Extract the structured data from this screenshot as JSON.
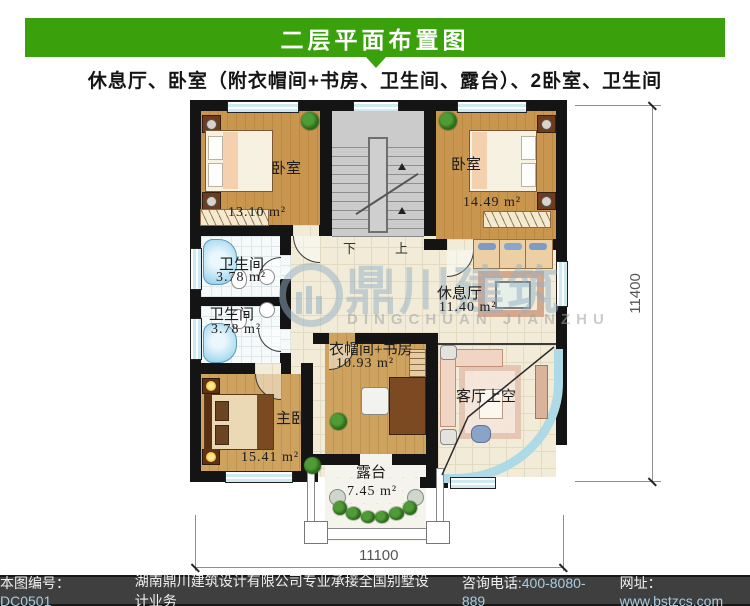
{
  "header": {
    "title": "二层平面布置图",
    "subtitle": "休息厅、卧室（附衣帽间+书房、卫生间、露台）、2卧室、卫生间",
    "accent_color": "#3aa10c"
  },
  "plan": {
    "rooms": {
      "bedroom_tl": {
        "label": "卧室",
        "area": "13.10 m²"
      },
      "bedroom_tr": {
        "label": "卧室",
        "area": "14.49 m²"
      },
      "bath_1": {
        "label": "卫生间",
        "area": "3.78 m²"
      },
      "bath_2": {
        "label": "卫生间",
        "area": "3.78 m²"
      },
      "lounge": {
        "label": "休息厅",
        "area": "11.40 m²"
      },
      "cloak_study": {
        "label": "衣帽间+书房",
        "area": "10.93 m²"
      },
      "master": {
        "label": "主卧",
        "area": "15.41 m²"
      },
      "living_void": {
        "label": "客厅上空"
      },
      "terrace": {
        "label": "露台",
        "area": "7.45 m²"
      }
    },
    "stairs": {
      "down": "下",
      "up": "上"
    },
    "dimensions": {
      "bottom": "11100",
      "right": "11400"
    },
    "watermark": {
      "cn": "鼎川建筑",
      "en": "DINGCHUAN JIANZHU"
    }
  },
  "footer": {
    "sn_label": "本图编号：",
    "sn": "DC0501",
    "company": "湖南鼎川建筑设计有限公司专业承接全国别墅设计业务",
    "tel_label": "咨询电话:",
    "tel": "400-8080-889",
    "web_label": "网址：",
    "web": "www.bstzcs.com",
    "bg_color": "#3f3f3f",
    "value_color": "#a9cde0"
  }
}
